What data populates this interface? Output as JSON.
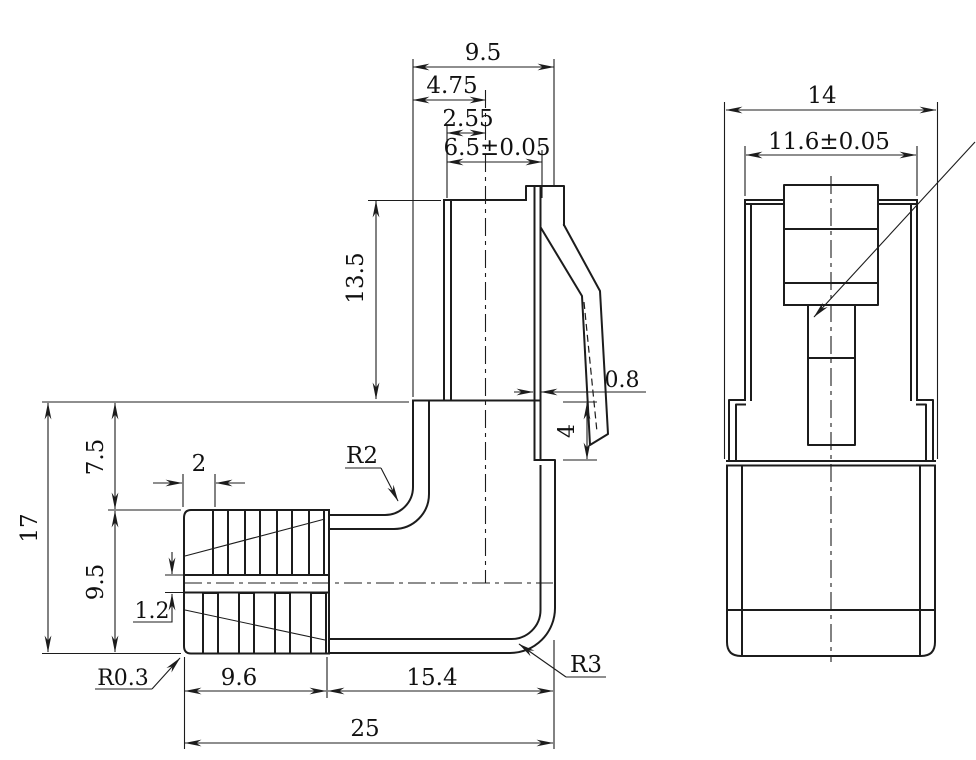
{
  "meta": {
    "background": "#ffffff",
    "line_color": "#1c1c1c",
    "drawing_type": "right-angle modular plug, two orthographic views"
  },
  "side_view": {
    "dims": {
      "top_width": "9.5",
      "top_half_width": "4.75",
      "contact_span": "2.55",
      "nose_width": "6.5±0.05",
      "nose_height": "13.5",
      "overall_height": "17",
      "upper_height": "7.5",
      "lower_height": "9.5",
      "rib_pitch": "2",
      "center_gap": "1.2",
      "boot_corner_radius": "R0.3",
      "inner_bend_radius": "R2",
      "outer_bend_radius": "R3",
      "latch_wall": "0.8",
      "shoulder_height": "4",
      "boot_length": "9.6",
      "arm_length": "15.4",
      "overall_length": "25"
    }
  },
  "front_view": {
    "dims": {
      "overall_width": "14",
      "nose_width": "11.6±0.05"
    }
  }
}
